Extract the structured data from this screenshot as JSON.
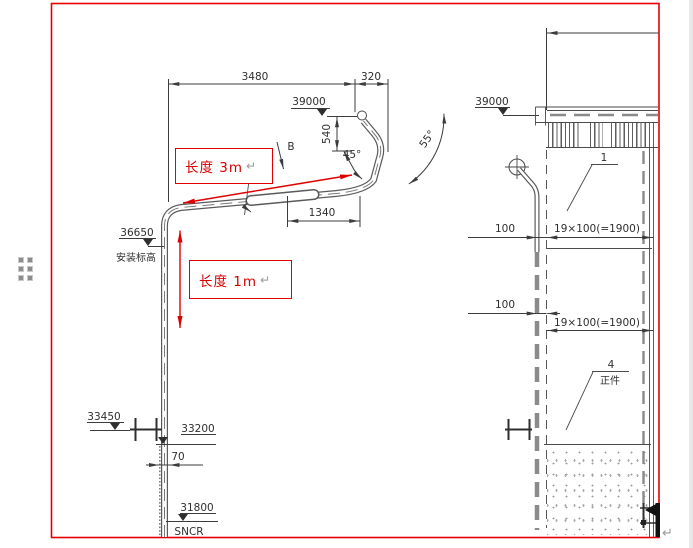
{
  "drawing": {
    "front_view": {
      "dim_3480": "3480",
      "dim_320": "320",
      "elev_39000": "39000",
      "dim_540": "540",
      "angle_45": "45°",
      "angle_55": "55°",
      "section_label": "B",
      "dim_1340": "1340",
      "elev_36650": "36650",
      "elev_36650_caption": "安装标高",
      "elev_33450": "33450",
      "elev_33200": "33200",
      "dim_70": "70",
      "elev_31800": "31800",
      "bottom_label": "SNCR"
    },
    "side_view": {
      "elev_39000": "39000",
      "part_label_1": "1",
      "dim_100_upper": "100",
      "dim_run_upper": "19×100(=1900)",
      "dim_100_lower": "100",
      "dim_run_lower": "19×100(=1900)",
      "part_label_4": "4",
      "part_4_caption": "正件"
    },
    "annotations": {
      "note_3m": "长度 3m",
      "note_1m": "长度 1m",
      "return_mark": "↵"
    },
    "colors": {
      "annotation_red": "#d40000",
      "border_red": "#e60000",
      "line_gray": "#3c3c3c"
    }
  }
}
